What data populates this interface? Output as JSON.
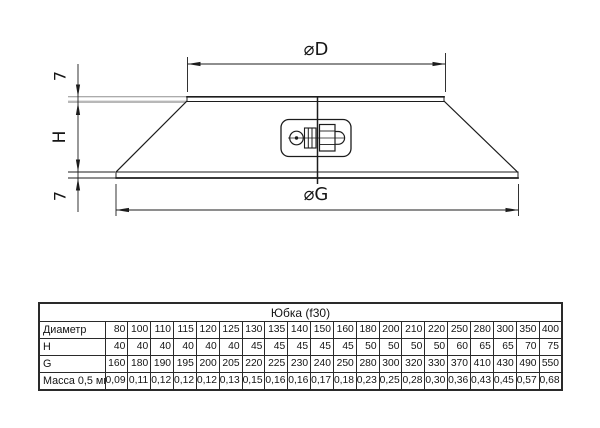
{
  "drawing": {
    "labels": {
      "diameter_top": "⌀D",
      "diameter_bottom": "⌀G",
      "height": "H",
      "lip_top": "7",
      "lip_bottom": "7"
    },
    "colors": {
      "ink": "#1c1c1c",
      "extension_gray": "#b8b8b8",
      "background": "#ffffff"
    }
  },
  "table": {
    "title": "Юбка (f30)",
    "rows": [
      {
        "header": "Диаметр",
        "values": [
          "80",
          "100",
          "110",
          "115",
          "120",
          "125",
          "130",
          "135",
          "140",
          "150",
          "160",
          "180",
          "200",
          "210",
          "220",
          "250",
          "280",
          "300",
          "350",
          "400"
        ]
      },
      {
        "header": "H",
        "values": [
          "40",
          "40",
          "40",
          "40",
          "40",
          "40",
          "45",
          "45",
          "45",
          "45",
          "45",
          "50",
          "50",
          "50",
          "50",
          "60",
          "65",
          "65",
          "70",
          "75"
        ]
      },
      {
        "header": "G",
        "values": [
          "160",
          "180",
          "190",
          "195",
          "200",
          "205",
          "220",
          "225",
          "230",
          "240",
          "250",
          "280",
          "300",
          "320",
          "330",
          "370",
          "410",
          "430",
          "490",
          "550"
        ]
      },
      {
        "header": "Масса 0,5 мм",
        "values": [
          "0,09",
          "0,11",
          "0,12",
          "0,12",
          "0,12",
          "0,13",
          "0,15",
          "0,16",
          "0,16",
          "0,17",
          "0,18",
          "0,23",
          "0,25",
          "0,28",
          "0,30",
          "0,36",
          "0,43",
          "0,45",
          "0,57",
          "0,68"
        ]
      }
    ]
  }
}
